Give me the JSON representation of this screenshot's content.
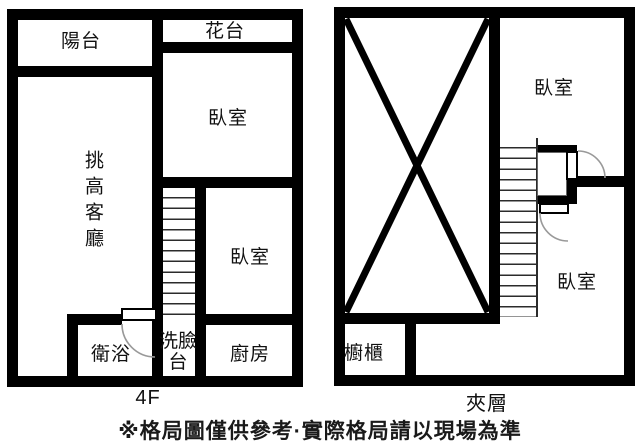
{
  "floors": {
    "f4": {
      "label": "4F",
      "rooms": {
        "balcony": "陽台",
        "flower_bed": "花台",
        "bedroom_top": "臥室",
        "living_room": "挑高客廳",
        "bedroom_mid": "臥室",
        "bathroom": "衛浴",
        "washbasin": "洗臉台",
        "kitchen": "廚房"
      }
    },
    "mezzanine": {
      "label": "夾層",
      "rooms": {
        "bedroom_top": "臥室",
        "bedroom_bottom": "臥室",
        "cabinet": "櫥櫃"
      }
    }
  },
  "footer": {
    "disclaimer": "※格局圖僅供參考·實際格局請以現場為準"
  },
  "colors": {
    "wall": "#000000",
    "background": "#ffffff",
    "door_arc": "#999999"
  }
}
